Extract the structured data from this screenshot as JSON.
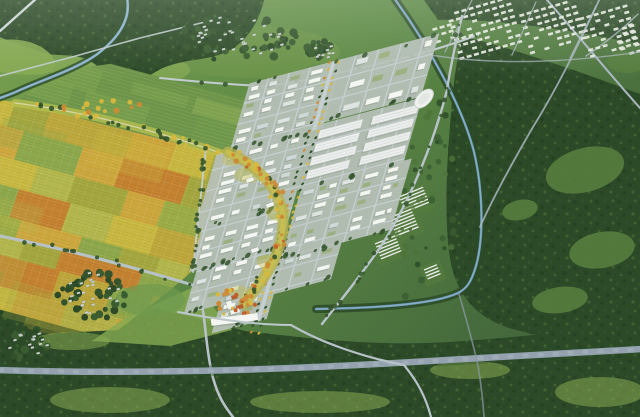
{
  "scene": {
    "title": "Aerial masterplan rendering of a planned new town",
    "description": "Bird's-eye architectural rendering: a dense new town of small white buildings with a golden central landscape axis and industrial sheds, bordered by a yellow-orange patchwork of farmland with a faint planning grid, a tree-lined greenway, winding blue rivers, dark forest belts, a highway crossing the foreground and distant white housing estates at the horizon.",
    "regions": [
      {
        "id": "farmland",
        "label": "Patchwork farmland with planning grid"
      },
      {
        "id": "greenway",
        "label": "Tree-lined greenway with autumn trees"
      },
      {
        "id": "new-town",
        "label": "New town of white building blocks"
      },
      {
        "id": "central-axis",
        "label": "Golden central landscape axis"
      },
      {
        "id": "industrial-zone",
        "label": "Industrial sheds and round tank"
      },
      {
        "id": "rivers",
        "label": "Winding river and canal"
      },
      {
        "id": "highway",
        "label": "Foreground highway with tree verge"
      },
      {
        "id": "forest",
        "label": "Dark forest belts"
      },
      {
        "id": "villages",
        "label": "Existing villages among trees"
      },
      {
        "id": "distant-estates",
        "label": "Distant white housing estates"
      },
      {
        "id": "greenhouses",
        "label": "Greenhouse / solar strip fields"
      },
      {
        "id": "fields",
        "label": "Green meadow fields"
      }
    ]
  },
  "palette": {
    "base_top": "#79a050",
    "base_mid": "#5e8a46",
    "base_bottom": "#41643a",
    "forest_dark": "#2c4a27",
    "forest_mid": "#3a5c31",
    "forest_light": "#4e7339",
    "clearing": "#567d3f",
    "field_light": "#86aa52",
    "field_mid": "#6d9449",
    "farm_yellow": "#cdbb41",
    "farm_gold": "#d3a93e",
    "farm_olive": "#a8a83f",
    "farm_orange": "#c9822f",
    "farm_green": "#8fa94c",
    "farm_lightgreen": "#b7b84d",
    "greenway_verge": "#b9c24f",
    "tree_dark": "#33532c",
    "tree_yellow": "#d8b83c",
    "tree_orange": "#cc8a35",
    "tree_red": "#bf5f2b",
    "river": "#7fa9c4",
    "canal": "#6f9cba",
    "road_white": "#d2d9db",
    "road_light": "#c3ccd0",
    "road_grey": "#a9b6c0",
    "highway": "#93a2ae",
    "highway_dash": "#aab7c1",
    "city_base": "#b7c1b8",
    "city_street": "#c6cfd2",
    "bldg_white": "#f4f6f2",
    "bldg_grey": "#dde4e2",
    "roof_blue": "#cfd9da",
    "bldg_shadow": "rgba(45,62,52,0.38)",
    "shed_white": "#ebeeec",
    "axis_olive": "#b5b24e",
    "axis_ground": "#c2bd55",
    "court_green": "#8ba657",
    "accent_orange": "#d08a3a",
    "accent_red": "#b85c2e",
    "village_house": "#cdd4d0",
    "distant_bldg": "#e6e9e0"
  }
}
